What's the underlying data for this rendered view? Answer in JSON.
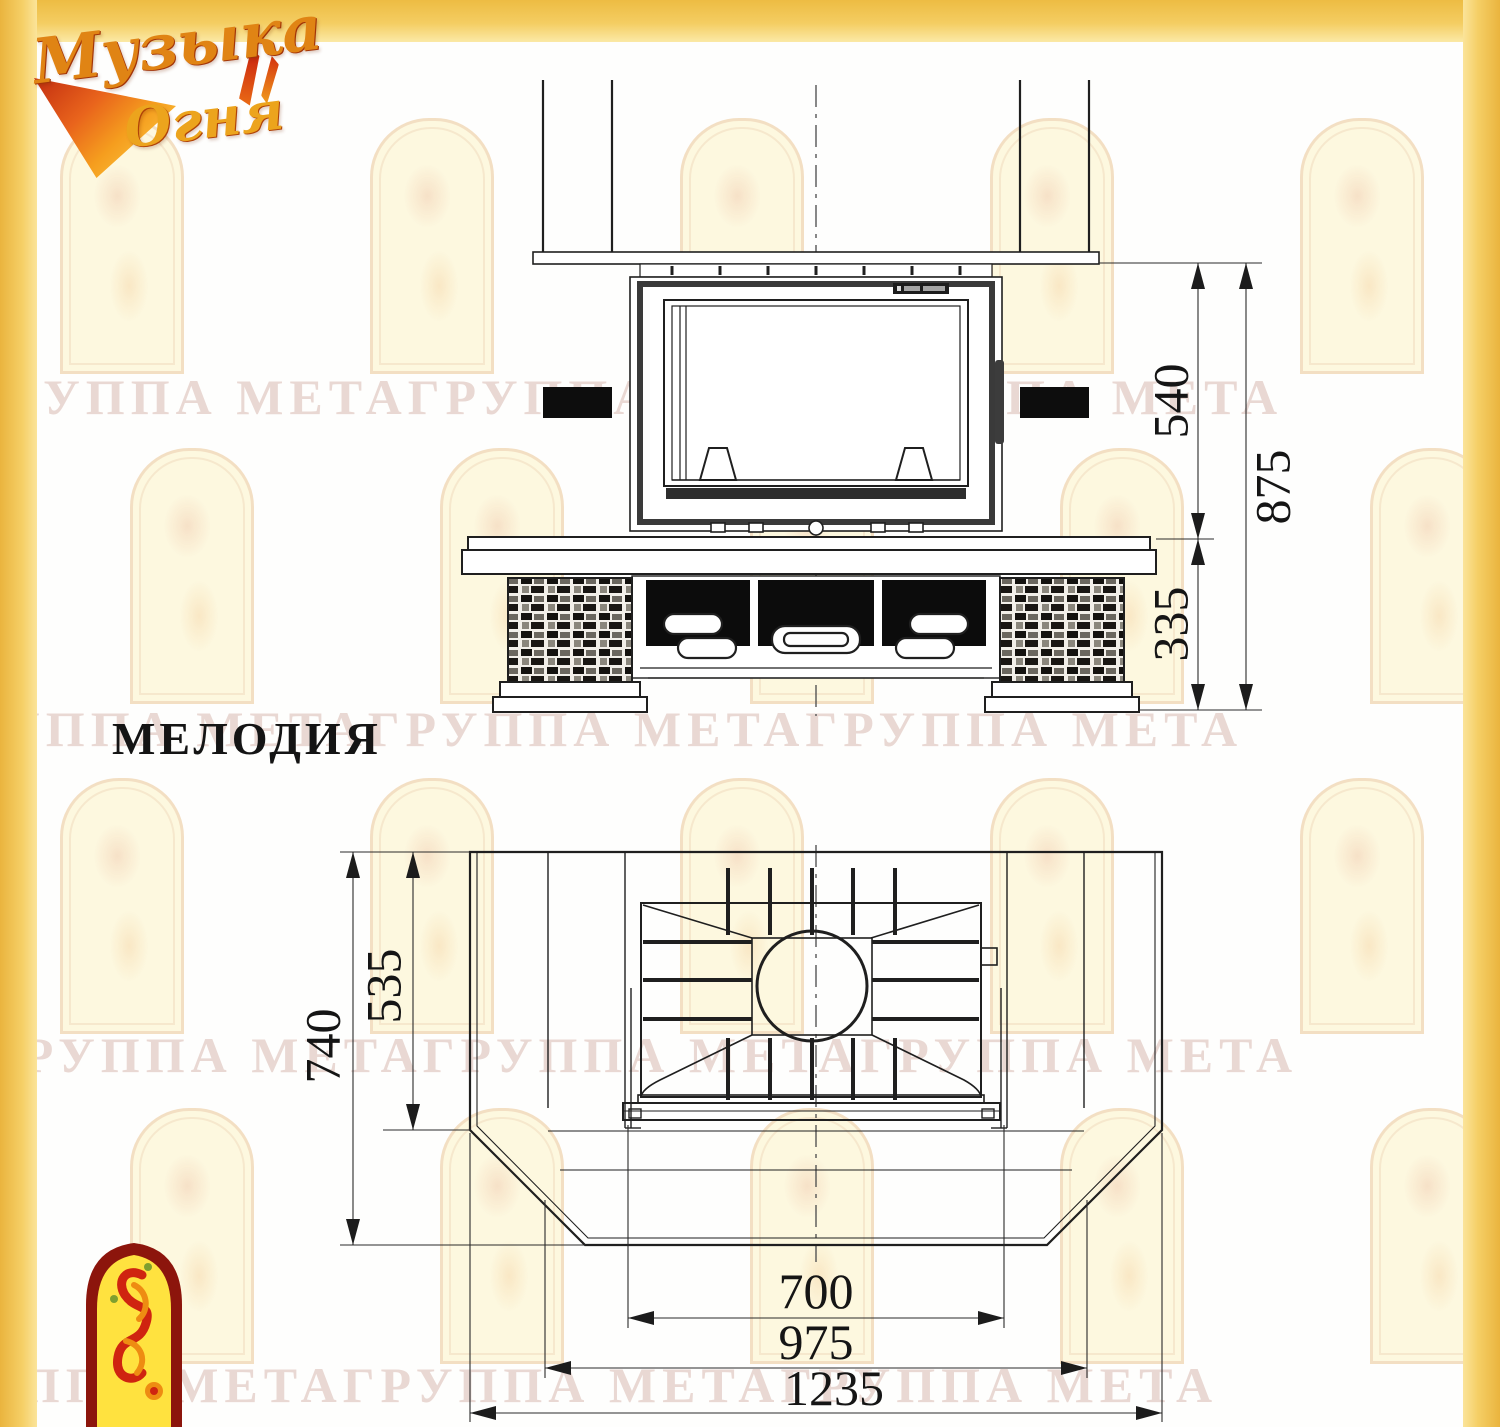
{
  "logo": {
    "word1": "Музыка",
    "word2": "Огня"
  },
  "title": "МЕЛОДИЯ",
  "watermark": {
    "text": "ГРУППА МЕТАГРУППА МЕТАГРУППА МЕТА"
  },
  "front_view": {
    "dim_firebox_height": "540",
    "dim_base_height": "335",
    "dim_total_height": "875"
  },
  "plan_view": {
    "dim_depth_total": "740",
    "dim_depth_firebox": "535",
    "dim_width_firebox": "700",
    "dim_width_inner": "975",
    "dim_width_total": "1235"
  },
  "colors": {
    "frame_yellow": "#f2c64f",
    "line_black": "#1f1f1f",
    "emblem_red": "#8c150c",
    "emblem_yellow": "#ffe23f"
  }
}
